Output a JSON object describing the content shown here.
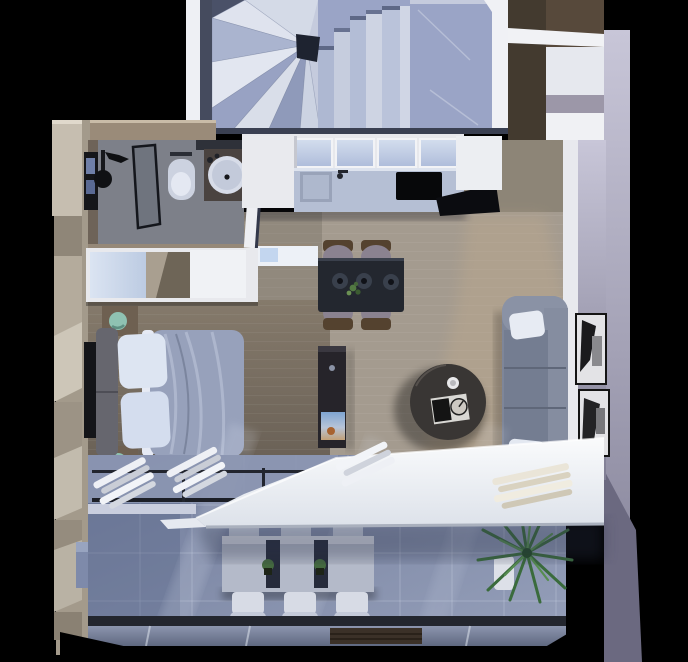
{
  "meta": {
    "title": "apartment-floor-plan-3d-render",
    "view": "top-down",
    "style": "photorealistic render, no visible text"
  },
  "palette": {
    "background": "#000000",
    "stair_marble": "#c5cbdd",
    "stair_landing": "#9aa4c6",
    "stair_center_dark": "#1e2330",
    "wall_white": "#f0f1f5",
    "wall_top_tan": "#9a8b79",
    "entry_wall_brown": "#433a2f",
    "outer_wall_beige": "#a39a8b",
    "right_wall_lavender": "#a9a7bc",
    "bathroom_floor": "#7d8089",
    "glass_cabinet": "#c9d4e8",
    "kitchen_counter": "#b5bfd4",
    "cooktop_black": "#07080a",
    "wood_living": "#a49b8f",
    "wood_bedroom": "#756b60",
    "wardrobe_white": "#e8e9ed",
    "headboard_gray": "#66666e",
    "duvet_blue": "#97a1bb",
    "pillow_white": "#dde5f2",
    "nightstand_brown": "#6e6051",
    "lamp_teal": "#8fc2b2",
    "dining_table_dark": "#23272f",
    "chair_mauve": "#8a8290",
    "chair_frame_brown": "#54422f",
    "tv_slab_dark": "#26242a",
    "coffee_table_brown": "#393634",
    "sofa_gray": "#7e8699",
    "picture_frame": "#e3e3e6",
    "glass_band_blue": "#8d97b2",
    "curtain_white": "#eef0f5",
    "curtain_cream": "#eae5d8",
    "awning_white": "#f2f4f8",
    "balcony_tile": "#7e88a5",
    "outdoor_table_stone": "#b4bac9",
    "outdoor_chair_white": "#d7dbe5",
    "palm_green": "#3a6b3c",
    "rail_dark": "#23262e"
  },
  "rooms": {
    "stairwell": {
      "label": "Stairwell",
      "items": [
        "winder-staircase",
        "stair-landing"
      ]
    },
    "entry": {
      "label": "Entry",
      "items": [
        "entry-walls"
      ]
    },
    "bathroom": {
      "label": "Bathroom",
      "items": [
        "shower-head",
        "shower-glass-partition",
        "toilet",
        "vanity-sink",
        "mirror",
        "window"
      ]
    },
    "kitchen": {
      "label": "Kitchen",
      "items": [
        "upper-glass-cabinets",
        "counter",
        "sink",
        "faucet",
        "cooktop",
        "tall-cabinets"
      ]
    },
    "bedroom": {
      "label": "Bedroom",
      "items": [
        "double-bed",
        "headboard",
        "pillows",
        "duvet",
        "nightstand-top",
        "nightstand-bottom",
        "sphere-lamps",
        "wall-tv-panel",
        "wardrobe"
      ]
    },
    "living_dining": {
      "label": "Living / Dining",
      "items": [
        "dining-table",
        "dining-chairs-4",
        "plates-3",
        "table-plant",
        "tv-partition",
        "coffee-table",
        "sofa-3-seat",
        "sofa-pillows",
        "wall-art-2"
      ]
    },
    "balcony": {
      "label": "Balcony",
      "items": [
        "sliding-glass-doors",
        "curtains",
        "awning",
        "outdoor-table",
        "outdoor-chairs-6",
        "potted-plants-2",
        "palm-plant",
        "glass-balustrade"
      ]
    }
  }
}
